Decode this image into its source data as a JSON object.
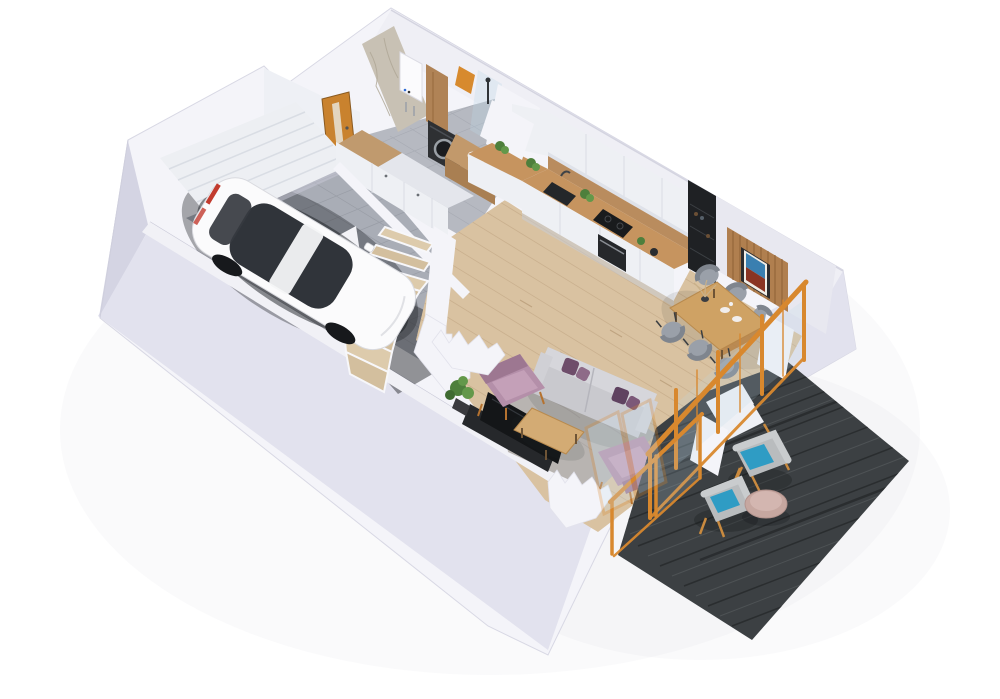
{
  "meta": {
    "description": "Isometric 3D cutaway floor plan render of a house ground floor with garage, hallway, bathroom-laundry, kitchen, dining area, living room, winder staircase and an outdoor terrace deck",
    "background": "#ffffff"
  },
  "palette": {
    "background": "#ffffff",
    "wall_top": "#f4f4f9",
    "wall_face": "#e2e2ee",
    "wall_face_dark": "#d4d4e3",
    "wall_inner": "#efeff5",
    "wall_line": "#d6d6e4",
    "garage_floor": "#a9adb6",
    "garage_tile_line": "#8f939c",
    "garage_dark": "#2d3034",
    "garage_door": "#edeff3",
    "garage_door_line": "#d9dde4",
    "door_amber": "#c9822e",
    "door_glass": "#e8e4d8",
    "marble": "#c8c1b4",
    "marble_vein": "#aea695",
    "boiler": "#fbfbfd",
    "wood_cabinet": "#b08356",
    "wardrobe_top": "#c09a6e",
    "washer": "#2e3033",
    "washer_ring": "#9aa0a6",
    "vanity_wood": "#c2996b",
    "vanity_front": "#a97f52",
    "basin": "#f3f3f5",
    "towel_orange": "#d78a2e",
    "bath_floor": "#b6b9c1",
    "bath_tile_line": "#9da1aa",
    "cabinet_white": "#eef0f4",
    "cabinet_line": "#d9dce3",
    "counter_wood": "#c6945f",
    "backsplash_wood": "#b98c5e",
    "sink_dark": "#24272a",
    "cooktop": "#191b1d",
    "oven": "#26282b",
    "appliance_black": "#1f2124",
    "wood_floor": "#d9c2a1",
    "plank_line": "#c3a987",
    "slat_wood": "#b07f4f",
    "slat_line": "#8e6136",
    "art_frame": "#2b2b2e",
    "art_sky": "#3a7fb0",
    "art_mountain": "#8a3423",
    "table_wood": "#cfa264",
    "chair_gray": "#9aa0a9",
    "chair_gray_dark": "#7f858e",
    "sofa": "#c9c9ce",
    "sofa_light": "#d6d6db",
    "cushion_purple": "#6e4d6a",
    "cushion_purple2": "#8e6b88",
    "armchair_mauve": "#b48fa9",
    "armchair_dark": "#9d7791",
    "armchair_seat": "#c4a0b8",
    "coffee_table": "#d3ab74",
    "rug": "#b8b4b1",
    "rug_dark": "#a49f9c",
    "tv": "#141618",
    "tv_stand": "#26282b",
    "plant_green": "#4e7f3c",
    "plant_green2": "#63984a",
    "plant_pot": "#3a3a3e",
    "railing_orange": "#d8882e",
    "glass_tint": "#bcd8e8",
    "deck": "#3c4043",
    "deck_dark": "#2a2d2f",
    "deck_light": "#5a5f62",
    "deck_chair": "#b9bcbe",
    "deck_chair_rim": "#c9ccce",
    "deck_cushion": "#2f9cc4",
    "deck_leg": "#c98a3f",
    "side_table_pink": "#c6a7a0",
    "side_table_hl": "#d3b6b0",
    "car_body": "#fbfbfc",
    "car_glass": "#30343a",
    "car_wheel": "#17191c",
    "car_tail": "#c23b2e"
  },
  "scene": {
    "rooms": [
      {
        "id": "garage",
        "floor": "gray tile"
      },
      {
        "id": "hallway",
        "floor": "gray tile"
      },
      {
        "id": "bathroom-laundry",
        "floor": "gray tile"
      },
      {
        "id": "kitchen",
        "floor": "light wood"
      },
      {
        "id": "dining-area",
        "floor": "light wood"
      },
      {
        "id": "living-room",
        "floor": "light wood"
      },
      {
        "id": "staircase",
        "type": "winder stairs, light wood treads"
      },
      {
        "id": "terrace-deck",
        "floor": "dark charcoal wood planks"
      }
    ],
    "objects": [
      {
        "id": "white-car",
        "room": "garage"
      },
      {
        "id": "garage-door",
        "room": "garage"
      },
      {
        "id": "amber-interior-door",
        "room": "garage"
      },
      {
        "id": "wardrobe",
        "room": "hallway"
      },
      {
        "id": "boiler",
        "room": "bathroom-laundry"
      },
      {
        "id": "washing-machine",
        "room": "bathroom-laundry"
      },
      {
        "id": "vanity-sink",
        "room": "bathroom-laundry"
      },
      {
        "id": "shower",
        "room": "bathroom-laundry"
      },
      {
        "id": "kitchen-cabinets",
        "room": "kitchen"
      },
      {
        "id": "kitchen-sink",
        "room": "kitchen"
      },
      {
        "id": "cooktop",
        "room": "kitchen"
      },
      {
        "id": "oven",
        "room": "kitchen"
      },
      {
        "id": "tall-black-cabinet",
        "room": "kitchen"
      },
      {
        "id": "slat-wall-panel",
        "room": "dining-area"
      },
      {
        "id": "wall-art",
        "room": "dining-area"
      },
      {
        "id": "dining-table",
        "room": "dining-area",
        "chairs": 6
      },
      {
        "id": "sofa",
        "room": "living-room",
        "pillows": 4
      },
      {
        "id": "armchair",
        "room": "living-room",
        "count": 2
      },
      {
        "id": "coffee-table",
        "room": "living-room"
      },
      {
        "id": "tv",
        "room": "living-room"
      },
      {
        "id": "rug",
        "room": "living-room"
      },
      {
        "id": "plant",
        "room": "living-room"
      },
      {
        "id": "orange-railing",
        "room": "terrace-deck"
      },
      {
        "id": "outdoor-armchair",
        "room": "terrace-deck",
        "count": 2
      },
      {
        "id": "round-side-table",
        "room": "terrace-deck"
      }
    ]
  }
}
